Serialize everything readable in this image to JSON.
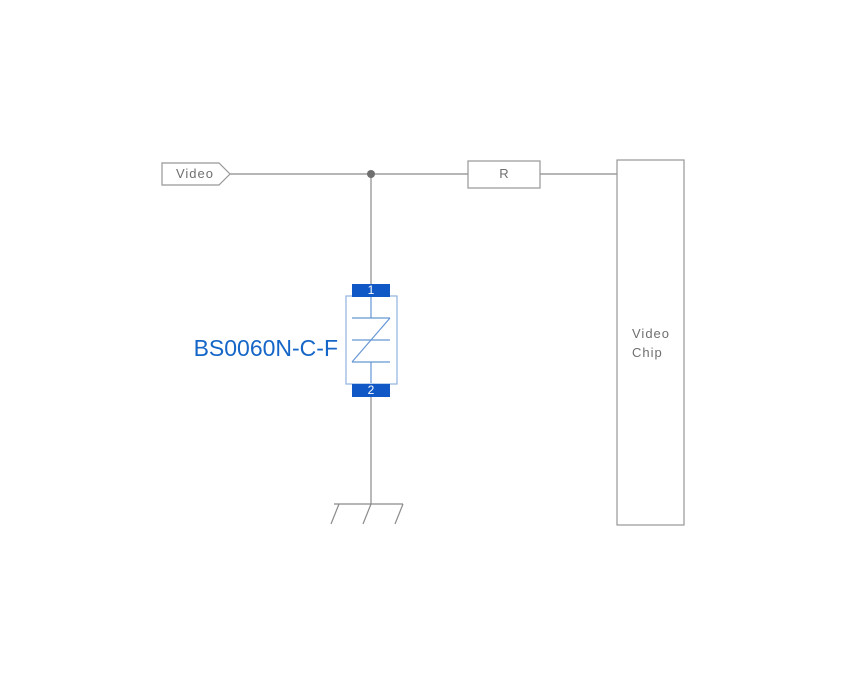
{
  "schematic": {
    "net_flag": {
      "label": "Video"
    },
    "resistor": {
      "label": "R"
    },
    "chip": {
      "label_lines": [
        "Video",
        "Chip"
      ]
    },
    "tvs": {
      "part_number": "BS0060N-C-F",
      "pin_top": "1",
      "pin_bottom": "2"
    }
  },
  "colors": {
    "background": "#ffffff",
    "wire": "#8a8a8a",
    "outline": "#979797",
    "text": "#6f6f6f",
    "dot": "#6f6f6f",
    "pad_blue": "#0f58c6",
    "body_blue": "#8fb2de",
    "symbol_blue": "#6596d4",
    "part_blue": "#1666c8"
  }
}
